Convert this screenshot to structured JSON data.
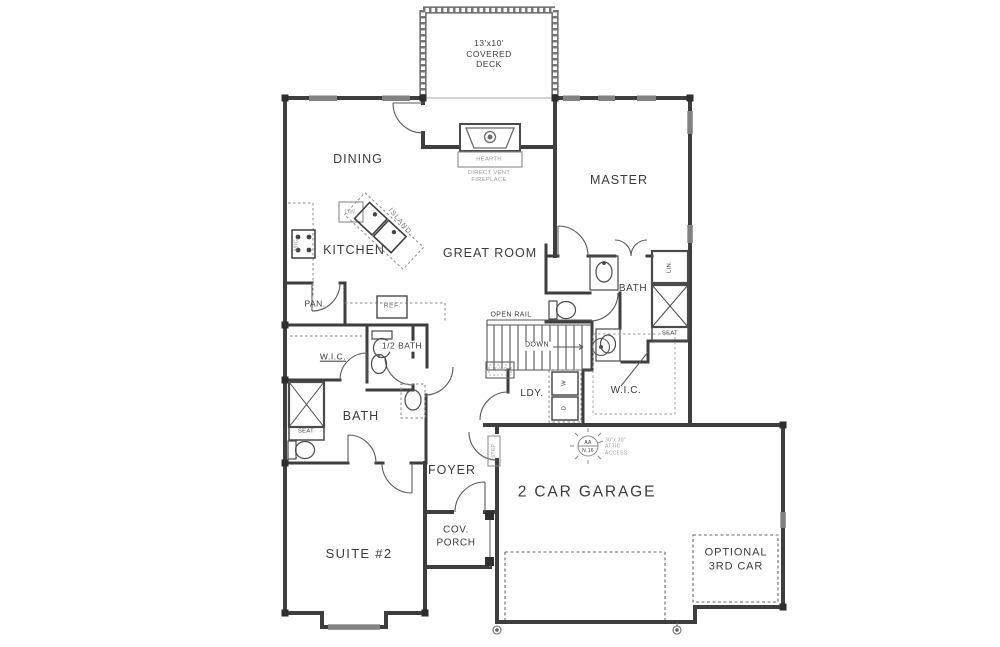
{
  "plan": {
    "rooms": {
      "covered_deck": "13'x10'\nCOVERED\nDECK",
      "dining": "DINING",
      "master": "MASTER",
      "kitchen": "KITCHEN",
      "great_room": "GREAT ROOM",
      "pantry": "PAN.",
      "wic_left": "W.I.C.",
      "half_bath": "1/2 BATH",
      "bath_left": "BATH",
      "bath_master": "BATH",
      "wic_master": "W.I.C.",
      "laundry": "LDY.",
      "foyer": "FOYER",
      "suite_2": "SUITE #2",
      "cov_porch": "COV.\nPORCH",
      "garage": "2 CAR GARAGE",
      "optional_3rd_car": "OPTIONAL\n3RD CAR"
    },
    "fixtures": {
      "hearth": "HEARTH",
      "fireplace": "DIRECT VENT\nFIREPLACE",
      "island": "ISLAND",
      "dishwasher": "DW.",
      "microwave": "MIC.",
      "refrigerator": "REF.",
      "washer": "W",
      "dryer": "D",
      "linen": "LIN.",
      "seat_master": "SEAT",
      "seat_suite": "SEAT",
      "hvac": "HVAC",
      "step": "STEP",
      "open_rail": "OPEN RAIL",
      "down": "DOWN"
    },
    "annotations": {
      "attic_symbol_top": "AA",
      "attic_symbol_bottom": "N.16",
      "attic_access": "30\"x 30\"\nATTIC\nACCESS"
    },
    "colors": {
      "wall": "#3e3e3e",
      "window": "#828282",
      "label": "#3b3b3b",
      "faded": "#9b9b9b",
      "background": "#ffffff"
    }
  }
}
